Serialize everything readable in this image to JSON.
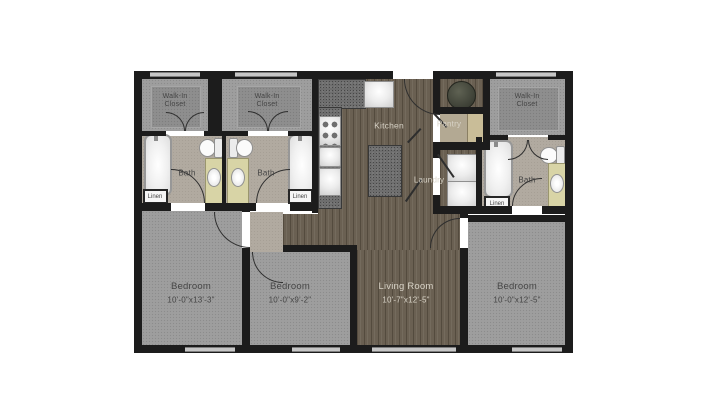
{
  "rooms": {
    "walk_in_closet_1": {
      "label": "Walk-In\nCloset"
    },
    "walk_in_closet_2": {
      "label": "Walk-In\nCloset"
    },
    "walk_in_closet_3": {
      "label": "Walk-In\nCloset"
    },
    "bath_1": {
      "label": "Bath"
    },
    "bath_2": {
      "label": "Bath"
    },
    "bath_3": {
      "label": "Bath"
    },
    "linen_1": {
      "label": "Linen"
    },
    "linen_2": {
      "label": "Linen"
    },
    "linen_3": {
      "label": "Linen"
    },
    "kitchen": {
      "label": "Kitchen"
    },
    "pantry": {
      "label": "Pantry"
    },
    "laundry": {
      "label": "Laundry"
    },
    "living_room": {
      "label": "Living Room",
      "dimensions": "10'-7\"x12'-5\""
    },
    "bedroom_1": {
      "label": "Bedroom",
      "dimensions": "10'-0\"x13'-3\""
    },
    "bedroom_2": {
      "label": "Bedroom",
      "dimensions": "10'-0\"x9'-2\""
    },
    "bedroom_3": {
      "label": "Bedroom",
      "dimensions": "10'-0\"x12'-5\""
    }
  },
  "colors": {
    "wall": "#1c1c1c",
    "carpet": "#9d9d9d",
    "wood_floor": "#6a6052",
    "tile_floor": "#b1aaa0",
    "vanity": "#d8d4a6",
    "background": "#ffffff"
  }
}
